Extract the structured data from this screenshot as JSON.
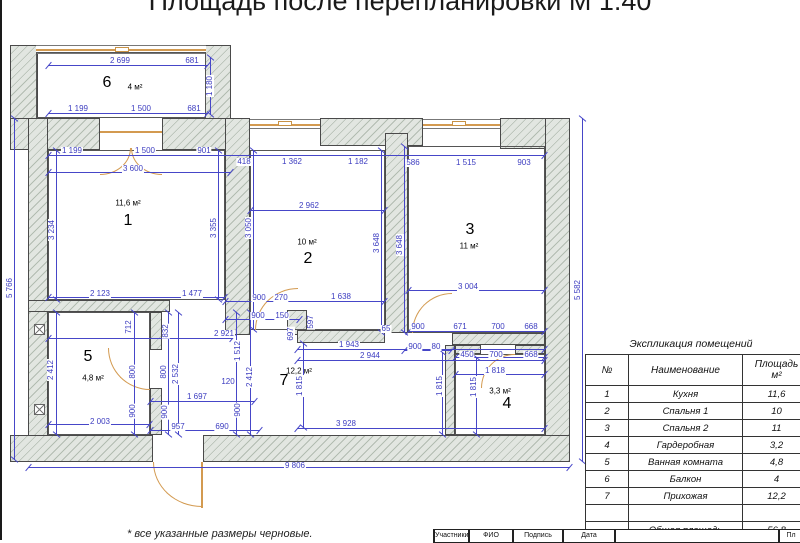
{
  "title": "Площадь после перепланировки М 1:40",
  "footnote": "* все указанные размеры черновые.",
  "colors": {
    "dimension_blue": "#4444c4",
    "door_tan": "#d39a50",
    "wall_fill": "#dfe3de",
    "wall_line": "#4a4a4a"
  },
  "plan": {
    "rooms": [
      {
        "num": "6",
        "area": "4 м²",
        "nx": 107,
        "ny": 83,
        "ax": 135,
        "ay": 87
      },
      {
        "num": "1",
        "area": "11,6 м²",
        "nx": 128,
        "ny": 221,
        "ax": 128,
        "ay": 203
      },
      {
        "num": "2",
        "area": "10 м²",
        "nx": 308,
        "ny": 259,
        "ax": 307,
        "ay": 242
      },
      {
        "num": "3",
        "area": "11 м²",
        "nx": 470,
        "ny": 230,
        "ax": 469,
        "ay": 246
      },
      {
        "num": "5",
        "area": "4,8 м²",
        "nx": 88,
        "ny": 357,
        "ax": 93,
        "ay": 378
      },
      {
        "num": "7",
        "area": "12,2 м²",
        "nx": 284,
        "ny": 381,
        "ax": 299,
        "ay": 371
      },
      {
        "num": "4",
        "area": "3,3 м²",
        "nx": 507,
        "ny": 404,
        "ax": 500,
        "ay": 391
      }
    ],
    "dimensions": [
      {
        "t": "2 699",
        "x": 120,
        "y": 61,
        "o": "h"
      },
      {
        "t": "681",
        "x": 192,
        "y": 61,
        "o": "h"
      },
      {
        "t": "1 199",
        "x": 78,
        "y": 109,
        "o": "h"
      },
      {
        "t": "1 500",
        "x": 141,
        "y": 109,
        "o": "h"
      },
      {
        "t": "681",
        "x": 194,
        "y": 109,
        "o": "h"
      },
      {
        "t": "1 180",
        "x": 210,
        "y": 86,
        "o": "v"
      },
      {
        "t": "1 199",
        "x": 72,
        "y": 151,
        "o": "h"
      },
      {
        "t": "1 500",
        "x": 145,
        "y": 151,
        "o": "h"
      },
      {
        "t": "901",
        "x": 204,
        "y": 151,
        "o": "h"
      },
      {
        "t": "418",
        "x": 244,
        "y": 162,
        "o": "h"
      },
      {
        "t": "1 362",
        "x": 292,
        "y": 162,
        "o": "h"
      },
      {
        "t": "1 182",
        "x": 358,
        "y": 162,
        "o": "h"
      },
      {
        "t": "586",
        "x": 413,
        "y": 163,
        "o": "h"
      },
      {
        "t": "1 515",
        "x": 466,
        "y": 163,
        "o": "h"
      },
      {
        "t": "903",
        "x": 524,
        "y": 163,
        "o": "h"
      },
      {
        "t": "3 600",
        "x": 133,
        "y": 169,
        "o": "h"
      },
      {
        "t": "2 962",
        "x": 309,
        "y": 206,
        "o": "h"
      },
      {
        "t": "3 234",
        "x": 52,
        "y": 230,
        "o": "v"
      },
      {
        "t": "3 355",
        "x": 214,
        "y": 228,
        "o": "v"
      },
      {
        "t": "3 050",
        "x": 249,
        "y": 228,
        "o": "v"
      },
      {
        "t": "3 648",
        "x": 377,
        "y": 243,
        "o": "v"
      },
      {
        "t": "3 648",
        "x": 400,
        "y": 245,
        "o": "v"
      },
      {
        "t": "3 004",
        "x": 468,
        "y": 287,
        "o": "h"
      },
      {
        "t": "5 766",
        "x": 10,
        "y": 288,
        "o": "v"
      },
      {
        "t": "5 582",
        "x": 578,
        "y": 290,
        "o": "v"
      },
      {
        "t": "2 123",
        "x": 100,
        "y": 294,
        "o": "h"
      },
      {
        "t": "1 477",
        "x": 192,
        "y": 294,
        "o": "h"
      },
      {
        "t": "900",
        "x": 259,
        "y": 298,
        "o": "h"
      },
      {
        "t": "270",
        "x": 281,
        "y": 298,
        "o": "h"
      },
      {
        "t": "1 638",
        "x": 341,
        "y": 297,
        "o": "h"
      },
      {
        "t": "900",
        "x": 258,
        "y": 316,
        "o": "h"
      },
      {
        "t": "150",
        "x": 282,
        "y": 316,
        "o": "h"
      },
      {
        "t": "2 921",
        "x": 224,
        "y": 334,
        "o": "h"
      },
      {
        "t": "597",
        "x": 311,
        "y": 322,
        "o": "v"
      },
      {
        "t": "697",
        "x": 291,
        "y": 334,
        "o": "v"
      },
      {
        "t": "65",
        "x": 386,
        "y": 329,
        "o": "h"
      },
      {
        "t": "900",
        "x": 418,
        "y": 327,
        "o": "h"
      },
      {
        "t": "671",
        "x": 460,
        "y": 327,
        "o": "h"
      },
      {
        "t": "700",
        "x": 498,
        "y": 327,
        "o": "h"
      },
      {
        "t": "668",
        "x": 531,
        "y": 327,
        "o": "h"
      },
      {
        "t": "900",
        "x": 415,
        "y": 347,
        "o": "h"
      },
      {
        "t": "80",
        "x": 436,
        "y": 347,
        "o": "h"
      },
      {
        "t": "1 943",
        "x": 349,
        "y": 345,
        "o": "h"
      },
      {
        "t": "2 944",
        "x": 370,
        "y": 356,
        "o": "h"
      },
      {
        "t": "450",
        "x": 467,
        "y": 355,
        "o": "h"
      },
      {
        "t": "700",
        "x": 496,
        "y": 355,
        "o": "h"
      },
      {
        "t": "668",
        "x": 531,
        "y": 355,
        "o": "h"
      },
      {
        "t": "1 818",
        "x": 495,
        "y": 371,
        "o": "h"
      },
      {
        "t": "712",
        "x": 129,
        "y": 327,
        "o": "v"
      },
      {
        "t": "832",
        "x": 166,
        "y": 331,
        "o": "v"
      },
      {
        "t": "800",
        "x": 133,
        "y": 372,
        "o": "v"
      },
      {
        "t": "800",
        "x": 164,
        "y": 372,
        "o": "v"
      },
      {
        "t": "2 532",
        "x": 176,
        "y": 374,
        "o": "v"
      },
      {
        "t": "900",
        "x": 133,
        "y": 411,
        "o": "v"
      },
      {
        "t": "900",
        "x": 165,
        "y": 412,
        "o": "v"
      },
      {
        "t": "2 412",
        "x": 51,
        "y": 370,
        "o": "v"
      },
      {
        "t": "1 512",
        "x": 238,
        "y": 351,
        "o": "v"
      },
      {
        "t": "900",
        "x": 238,
        "y": 410,
        "o": "v"
      },
      {
        "t": "2 412",
        "x": 250,
        "y": 377,
        "o": "v"
      },
      {
        "t": "120",
        "x": 228,
        "y": 382,
        "o": "h"
      },
      {
        "t": "1 815",
        "x": 300,
        "y": 386,
        "o": "v"
      },
      {
        "t": "1 815",
        "x": 440,
        "y": 386,
        "o": "v"
      },
      {
        "t": "1 815",
        "x": 474,
        "y": 387,
        "o": "v"
      },
      {
        "t": "1 697",
        "x": 197,
        "y": 397,
        "o": "h"
      },
      {
        "t": "2 003",
        "x": 100,
        "y": 422,
        "o": "h"
      },
      {
        "t": "957",
        "x": 178,
        "y": 427,
        "o": "h"
      },
      {
        "t": "690",
        "x": 222,
        "y": 427,
        "o": "h"
      },
      {
        "t": "3 928",
        "x": 346,
        "y": 424,
        "o": "h"
      },
      {
        "t": "9 806",
        "x": 295,
        "y": 466,
        "o": "h"
      }
    ]
  },
  "table": {
    "title": "Экспликация помещений",
    "headers": {
      "num": "№",
      "name": "Наименование",
      "area": "Площадь\nм²"
    },
    "rows": [
      {
        "num": "1",
        "name": "Кухня",
        "area": "11,6"
      },
      {
        "num": "2",
        "name": "Спальня 1",
        "area": "10"
      },
      {
        "num": "3",
        "name": "Спальня 2",
        "area": "11"
      },
      {
        "num": "4",
        "name": "Гардеробная",
        "area": "3,2"
      },
      {
        "num": "5",
        "name": "Ванная комната",
        "area": "4,8"
      },
      {
        "num": "6",
        "name": "Балкон",
        "area": "4"
      },
      {
        "num": "7",
        "name": "Прихожая",
        "area": "12,2"
      },
      {
        "num": "",
        "name": "",
        "area": ""
      }
    ],
    "total": {
      "label": "Общая площадь",
      "value": "56,8"
    }
  },
  "stamp": {
    "cells": [
      "Участники",
      "ФИО",
      "Подпись",
      "Дата",
      "",
      "Пл"
    ]
  }
}
